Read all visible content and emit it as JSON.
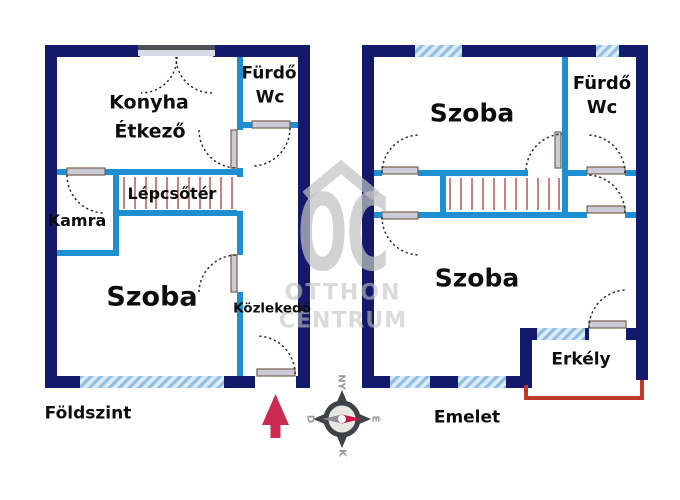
{
  "floor_plan": {
    "ground_floor": {
      "label": "Földszint",
      "rooms": {
        "konyha": "Konyha",
        "etkezo": "Étkező",
        "furdo": "Fürdő",
        "wc": "Wc",
        "lepcsoter": "Lépcsőtér",
        "kamra": "Kamra",
        "szoba": "Szoba",
        "kozlekedo": "Közlekedő"
      }
    },
    "upper_floor": {
      "label": "Emelet",
      "rooms": {
        "szoba_felso": "Szoba",
        "furdo": "Fürdő",
        "wc": "Wc",
        "szoba_also": "Szoba",
        "erkely": "Erkély"
      }
    }
  },
  "compass": {
    "top": "NY",
    "left": "D",
    "right": "É",
    "bottom": "K"
  },
  "watermark": {
    "monogram": "OC",
    "name_line1": "OTTHON",
    "name_line2": "CENTRUM"
  },
  "colors": {
    "outer_wall": "#141a6b",
    "inner_wall": "#1e8fd3",
    "window_fill": "#dcebf7",
    "window_stripe": "#90bfe2",
    "stairs": "#c4605c",
    "balcony_rail": "#c0392b",
    "compass_needle": "#c21747",
    "north_arrow": "#cd2a52",
    "watermark": "#c2c2c2"
  }
}
